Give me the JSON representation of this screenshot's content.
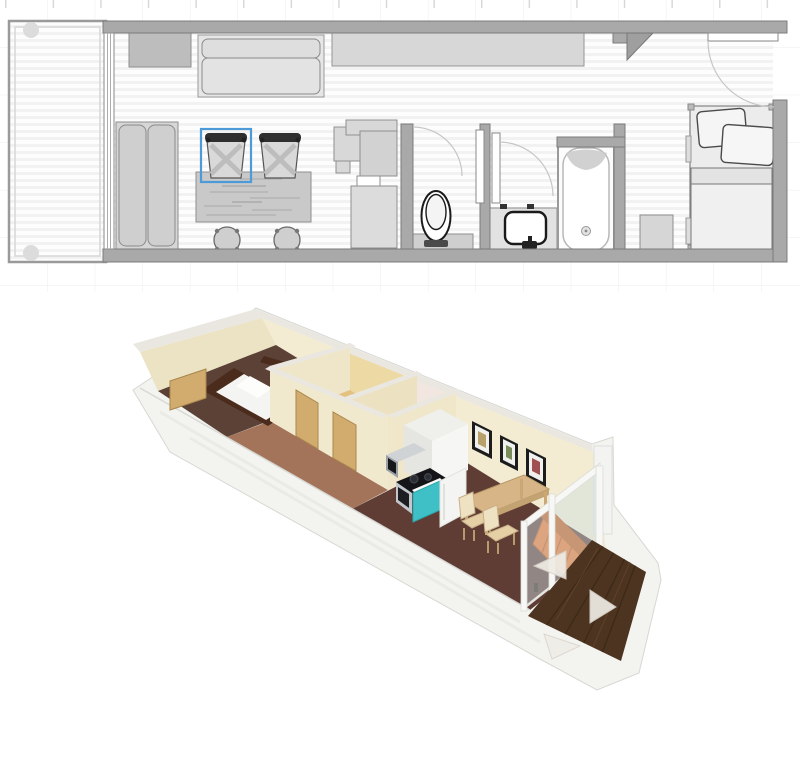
{
  "app": {
    "type": "floor-planner-canvas",
    "views": [
      "2d-floor-plan",
      "3d-dollhouse-view"
    ]
  },
  "palette": {
    "background": "#ffffff",
    "grid_line": "#ececec",
    "grid_tick": "#d8d8d8",
    "wall_2d": "#a9a9a9",
    "wall_2d_stroke": "#7c7c7c",
    "floor_stripe": "#f2f2f2",
    "furniture_fill": "#d8d8d8",
    "furniture_stroke": "#8f8f8f",
    "chair_back": "#2f2f2f",
    "selection": "#4d9ad8",
    "cream_wall": "#f3ecd2",
    "cream_wall_shade": "#ece3c4",
    "tan_wall": "#ecd9a4",
    "pink_wall": "#f2e6e1",
    "wall_top": "#e9e7e0",
    "white_exterior": "#f3f3f0",
    "exterior_stroke": "#d7d7d3",
    "floor_bedroom_3d": "#5c4136",
    "floor_living_3d": "#5f3d35",
    "corridor_wood": "#a3745a",
    "bath_floor": "#e5c17f",
    "wc_floor": "#efe5df",
    "deck_wood": "#4d3420",
    "deck_streak": "#3a2715",
    "door_tan": "#d2ac6e",
    "door_edge": "#a9874c",
    "bed_frame_3d": "#4a2b1c",
    "sofa_orange": "#e8742e",
    "sofa_orange_dark": "#c05a1d",
    "kitchen_teal": "#3fc0c6",
    "cooktop_black": "#141419",
    "appliance_steel": "#c3c7cb",
    "table_wood": "#d7b586",
    "chair_wood_3d": "#e5cfa4",
    "picture_frame": "#1c1c1c",
    "glass": "#cfe0e2",
    "nav_arrow": "#efece5"
  },
  "plan_2d": {
    "selection": {
      "selected_object": "dining-chair",
      "highlight_color": "#4d9ad8"
    },
    "objects": [
      "deck",
      "deck-post",
      "glass-sliding-door",
      "tv-cabinet",
      "daybed-sofa",
      "wall-wardrobe",
      "sofa",
      "dining-table",
      "dining-chair-selected",
      "dining-chair",
      "stool",
      "stool",
      "kitchen-counter",
      "toilet",
      "pocket-door",
      "pocket-door",
      "sink-vanity",
      "bathtub",
      "corner-shelf",
      "nightstand",
      "single-bed",
      "entry-door",
      "door-swing-arc"
    ]
  },
  "view_3d": {
    "objects": [
      "exterior-walls",
      "bedroom-floor",
      "bed",
      "bedroom-door",
      "bathroom",
      "wc-room",
      "hallway-doors",
      "kitchen-cabinet",
      "microwave",
      "cooktop",
      "oven",
      "teal-cabinet",
      "fridge",
      "wall-pictures",
      "dining-table",
      "dining-chairs",
      "orange-sofa",
      "glass-wall",
      "deck-floor",
      "navigation-arrows"
    ],
    "picture_count": 3,
    "navigation_arrow_count": 3
  }
}
